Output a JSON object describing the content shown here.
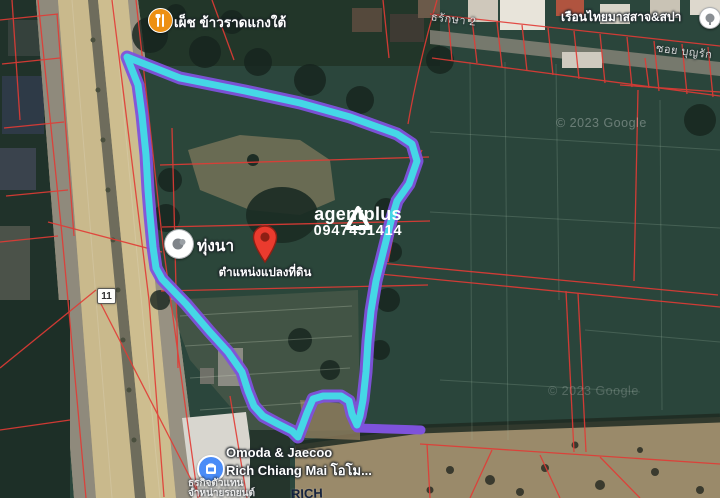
{
  "map": {
    "attribution": "© 2023 Google",
    "highway_badge": "11",
    "labels": {
      "restaurant": "เผ็ช ข้าวราดแกงใต้",
      "street_top_right": "ธรักษา 2",
      "spa": "เรือนไทยมาสสาจ&สปา",
      "soi_bottom": "ซอย บุญรัก",
      "field_poi": "ทุ่งนา",
      "pin_caption": "ตำแหน่งแปลงที่ดิน",
      "dealership_line1": "Omoda & Jaecoo",
      "dealership_line2": "Rich Chiang Mai โอโม...",
      "dealership_sub1": "ธุรกิจตัวแทน",
      "dealership_sub2": "จำหน่ายรถยนต์",
      "building_sign": "RICH"
    },
    "branding": {
      "name": "agentplus",
      "phone": "0947451414"
    },
    "colors": {
      "boundary_outer_purple": "#7E52DC",
      "boundary_inner_cyan": "#45D7E6",
      "parcel_line_red": "#E23B35",
      "pin_red": "#EA3B2E",
      "restaurant_icon_orange": "#ED9013",
      "dealer_icon_blue": "#4A8CF7",
      "highway_tan": "#C9B98C",
      "field_dark_green": "#2B463C"
    }
  }
}
